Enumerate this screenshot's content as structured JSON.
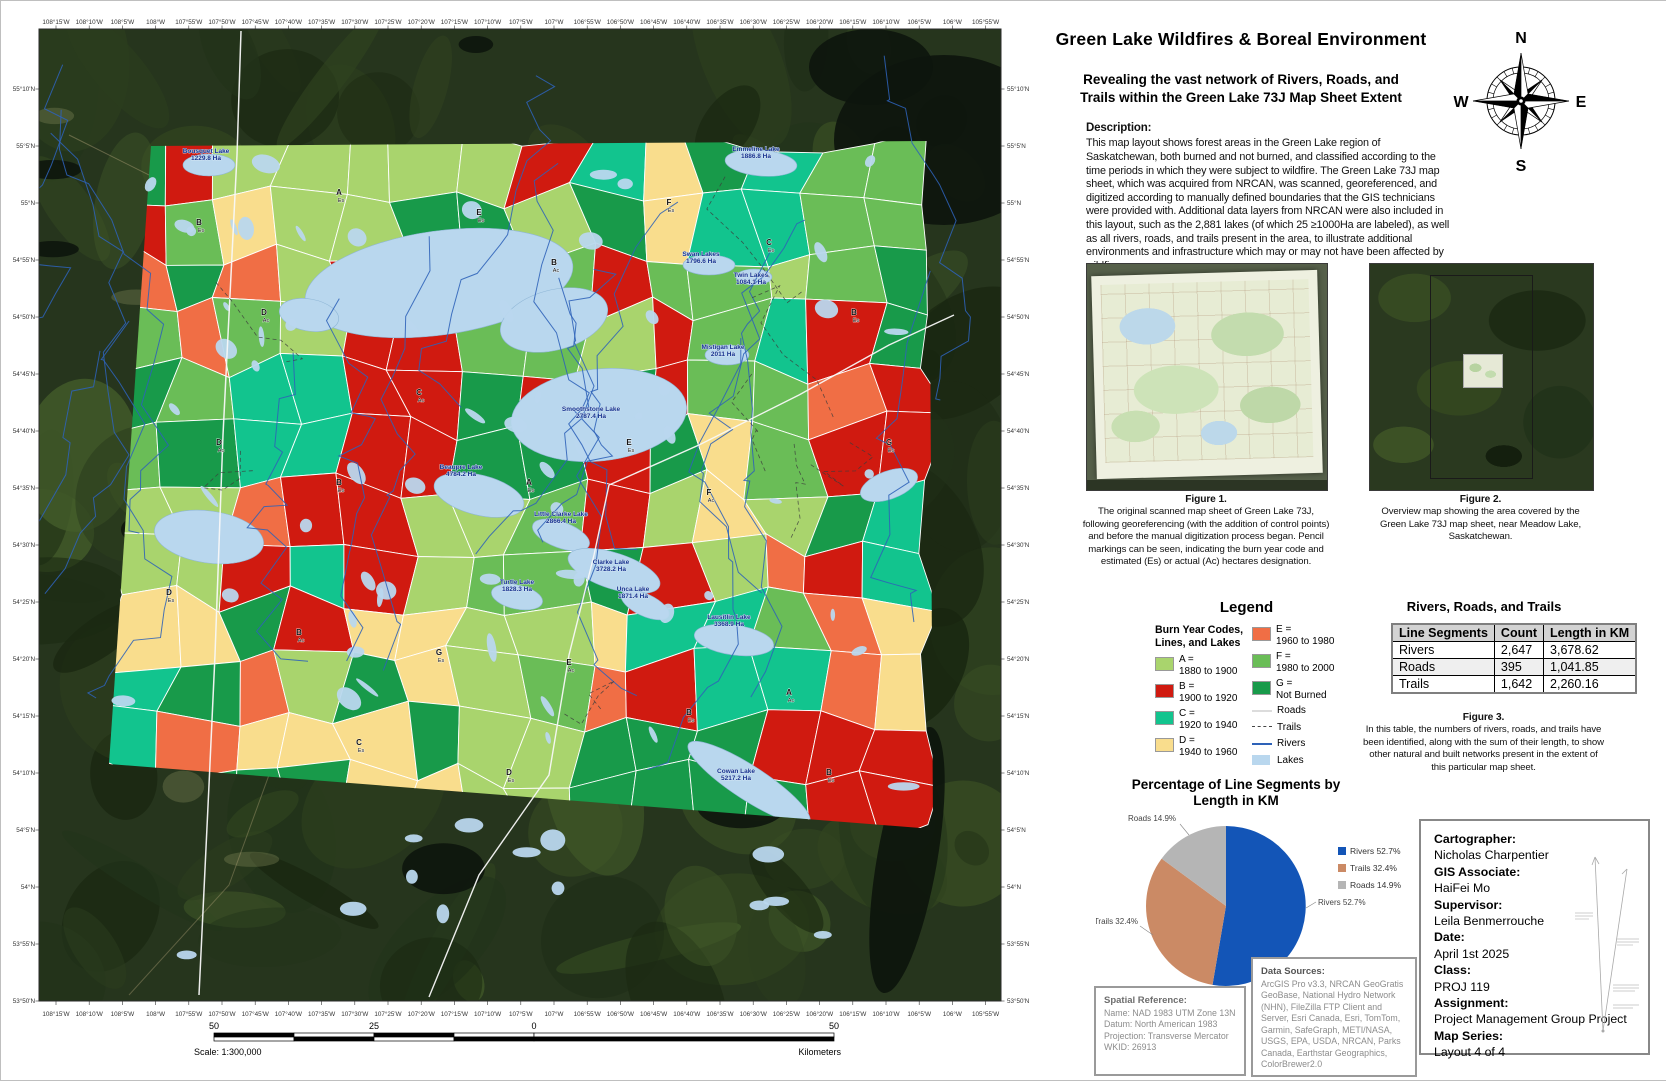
{
  "title_block": {
    "title": "Green Lake Wildfires & Boreal Environment",
    "subtitle_1": "Revealing the vast network of Rivers, Roads, and",
    "subtitle_2": "Trails within the Green Lake 73J Map Sheet Extent"
  },
  "compass": {
    "n": "N",
    "e": "E",
    "s": "S",
    "w": "W"
  },
  "description": {
    "heading": "Description:",
    "body": "This map layout shows forest areas in the Green Lake region of Saskatchewan, both burned and not burned, and classified according to the time periods in which they were subject to wildfire. The Green Lake 73J map sheet, which was acquired from NRCAN, was scanned, georeferenced, and digitized according to manually defined boundaries that the GIS technicians were provided with. Additional data layers from NRCAN were also included in this layout, such as the 2,881 lakes (of which 25 ≥1000Ha are labeled), as well as all rivers, roads, and trails present in the area, to illustrate additional environments and infrastructure which may or may not have been affected by wildfires."
  },
  "figures": {
    "fig1": {
      "caption_title": "Figure 1.",
      "caption": "The original scanned map sheet of Green Lake 73J, following georeferencing (with the addition of control points) and before the manual digitization process began. Pencil markings can be seen, indicating the burn year code and estimated (Es) or actual (Ac) hectares designation."
    },
    "fig2": {
      "caption_title": "Figure 2.",
      "caption": "Overview map showing the area covered by the Green Lake 73J map sheet, near Meadow Lake, Saskatchewan."
    }
  },
  "legend": {
    "title": "Legend",
    "subtitle": "Burn Year Codes, Lines, and Lakes",
    "codes": [
      {
        "code": "A",
        "range": "1880 to 1900",
        "color": "#a9d46d"
      },
      {
        "code": "B",
        "range": "1900 to 1920",
        "color": "#d01a10"
      },
      {
        "code": "C",
        "range": "1920 to 1940",
        "color": "#12c48e"
      },
      {
        "code": "D",
        "range": "1940 to 1960",
        "color": "#f9dd8d"
      },
      {
        "code": "E",
        "range": "1960 to 1980",
        "color": "#f06e45"
      },
      {
        "code": "F",
        "range": "1980 to 2000",
        "color": "#6abd57"
      },
      {
        "code": "G",
        "range": "Not Burned",
        "color": "#189a4a"
      }
    ],
    "lines": [
      {
        "label": "Roads",
        "style": "road",
        "color": "#dcdcdc"
      },
      {
        "label": "Trails",
        "style": "trail",
        "color": "#444444"
      },
      {
        "label": "Rivers",
        "style": "river",
        "color": "#2e62b8"
      },
      {
        "label": "Lakes",
        "style": "lake",
        "color": "#b9d7ee"
      }
    ]
  },
  "table_block": {
    "title": "Rivers, Roads, and Trails",
    "headers": [
      "Line Segments",
      "Count",
      "Length in KM"
    ],
    "rows": [
      [
        "Rivers",
        "2,647",
        "3,678.62"
      ],
      [
        "Roads",
        "395",
        "1,041.85"
      ],
      [
        "Trails",
        "1,642",
        "2,260.16"
      ]
    ],
    "fig3_title": "Figure 3.",
    "fig3_caption": "In this table, the numbers of rivers, roads, and trails have been identified, along with the sum of their length, to show other natural and built networks present in the extent of this particular map sheet."
  },
  "chart_data": {
    "type": "pie",
    "title": "Percentage of Line Segments by Length in KM",
    "slices": [
      {
        "label": "Rivers",
        "pct": 52.7,
        "color": "#1355b7"
      },
      {
        "label": "Trails",
        "pct": 32.4,
        "color": "#cb8a65"
      },
      {
        "label": "Roads",
        "pct": 14.9,
        "color": "#b5b5b5"
      }
    ],
    "legend_position": "right"
  },
  "credits": {
    "items": [
      {
        "label": "Cartographer:",
        "value": "Nicholas Charpentier"
      },
      {
        "label": "GIS Associate:",
        "value": "HaiFei Mo"
      },
      {
        "label": "Supervisor:",
        "value": "Leila Benmerrouche"
      },
      {
        "label": "Date:",
        "value": "April 1st 2025"
      },
      {
        "label": "Class:",
        "value": "PROJ 119"
      },
      {
        "label": "Assignment:",
        "value": "Project Management Group Project"
      },
      {
        "label": "Map Series:",
        "value": "Layout 4 of 4"
      }
    ]
  },
  "spatial_reference": {
    "heading": "Spatial Reference:",
    "lines": [
      "Name: NAD 1983 UTM Zone 13N",
      "Datum: North American 1983",
      "Projection: Transverse Mercator",
      "WKID: 26913"
    ]
  },
  "data_sources": {
    "heading": "Data Sources:",
    "body": "ArcGIS Pro v3.3, NRCAN GeoGratis GeoBase, National Hydro Network (NHN), FileZilla FTP Client and Server, Esri Canada, Esri, TomTom, Garmin, SafeGraph, METI/NASA, USGS, EPA, USDA, NRCAN, Parks Canada, Earthstar Geographics, ColorBrewer2.0"
  },
  "scalebar": {
    "labels": [
      "50",
      "25",
      "0",
      "50"
    ],
    "units": "Kilometers",
    "scale_text": "Scale: 1:300,000"
  },
  "map": {
    "lon_labels": [
      "108°15'W",
      "108°10'W",
      "108°5'W",
      "108°W",
      "107°55'W",
      "107°50'W",
      "107°45'W",
      "107°40'W",
      "107°35'W",
      "107°30'W",
      "107°25'W",
      "107°20'W",
      "107°15'W",
      "107°10'W",
      "107°5'W",
      "107°W",
      "106°55'W",
      "106°50'W",
      "106°45'W",
      "106°40'W",
      "106°35'W",
      "106°30'W",
      "106°25'W",
      "106°20'W",
      "106°15'W",
      "106°10'W",
      "106°5'W",
      "106°W",
      "105°55'W"
    ],
    "lat_labels": [
      "55°10'N",
      "55°5'N",
      "55°N",
      "54°55'N",
      "54°50'N",
      "54°45'N",
      "54°40'N",
      "54°35'N",
      "54°30'N",
      "54°25'N",
      "54°20'N",
      "54°15'N",
      "54°10'N",
      "54°5'N",
      "54°N",
      "53°55'N",
      "53°50'N"
    ],
    "lake_labels": [
      {
        "name": "Bousquet Lake",
        "ha": "1229.8 Ha",
        "x": 197,
        "y": 138
      },
      {
        "name": "Emmeline Lake",
        "ha": "1886.8 Ha",
        "x": 747,
        "y": 136
      },
      {
        "name": "Swan Lakes",
        "ha": "1796.6 Ha",
        "x": 692,
        "y": 241
      },
      {
        "name": "Twin Lakes",
        "ha": "1084.1 Ha",
        "x": 742,
        "y": 262
      },
      {
        "name": "Mistigan Lake",
        "ha": "2011 Ha",
        "x": 714,
        "y": 334
      },
      {
        "name": "Smoothstone Lake",
        "ha": "2787.4 Ha",
        "x": 582,
        "y": 396
      },
      {
        "name": "Beaupre Lake",
        "ha": "4784.2 Ha",
        "x": 452,
        "y": 454
      },
      {
        "name": "Little Clarke Lake",
        "ha": "2866.4 Ha",
        "x": 552,
        "y": 501
      },
      {
        "name": "Turtle Lake",
        "ha": "1828.3 Ha",
        "x": 508,
        "y": 569
      },
      {
        "name": "Clarke Lake",
        "ha": "3728.2 Ha",
        "x": 602,
        "y": 549
      },
      {
        "name": "Unca Lake",
        "ha": "1871.4 Ha",
        "x": 624,
        "y": 576
      },
      {
        "name": "Lausitlin Lake",
        "ha": "3368.9 Ha",
        "x": 720,
        "y": 604
      },
      {
        "name": "Cowan Lake",
        "ha": "5217.2 Ha",
        "x": 727,
        "y": 758
      }
    ],
    "code_markers": [
      {
        "c": "B",
        "s": "Es",
        "x": 190,
        "y": 210
      },
      {
        "c": "D",
        "s": "Ac",
        "x": 255,
        "y": 300
      },
      {
        "c": "A",
        "s": "Es",
        "x": 330,
        "y": 180
      },
      {
        "c": "E",
        "s": "Es",
        "x": 470,
        "y": 200
      },
      {
        "c": "B",
        "s": "Ac",
        "x": 545,
        "y": 250
      },
      {
        "c": "F",
        "s": "Es",
        "x": 660,
        "y": 190
      },
      {
        "c": "C",
        "s": "Es",
        "x": 760,
        "y": 230
      },
      {
        "c": "B",
        "s": "Es",
        "x": 845,
        "y": 300
      },
      {
        "c": "G",
        "s": "Es",
        "x": 880,
        "y": 430
      },
      {
        "c": "D",
        "s": "Ac",
        "x": 210,
        "y": 430
      },
      {
        "c": "B",
        "s": "Es",
        "x": 330,
        "y": 470
      },
      {
        "c": "C",
        "s": "Ac",
        "x": 410,
        "y": 380
      },
      {
        "c": "A",
        "s": "Es",
        "x": 520,
        "y": 470
      },
      {
        "c": "E",
        "s": "Es",
        "x": 620,
        "y": 430
      },
      {
        "c": "F",
        "s": "Ac",
        "x": 700,
        "y": 480
      },
      {
        "c": "D",
        "s": "Es",
        "x": 160,
        "y": 580
      },
      {
        "c": "B",
        "s": "Ac",
        "x": 290,
        "y": 620
      },
      {
        "c": "G",
        "s": "Es",
        "x": 430,
        "y": 640
      },
      {
        "c": "E",
        "s": "Ac",
        "x": 560,
        "y": 650
      },
      {
        "c": "B",
        "s": "Es",
        "x": 680,
        "y": 700
      },
      {
        "c": "A",
        "s": "Ac",
        "x": 780,
        "y": 680
      },
      {
        "c": "C",
        "s": "Es",
        "x": 350,
        "y": 730
      },
      {
        "c": "D",
        "s": "Es",
        "x": 500,
        "y": 760
      },
      {
        "c": "B",
        "s": "Es",
        "x": 820,
        "y": 760
      }
    ]
  }
}
